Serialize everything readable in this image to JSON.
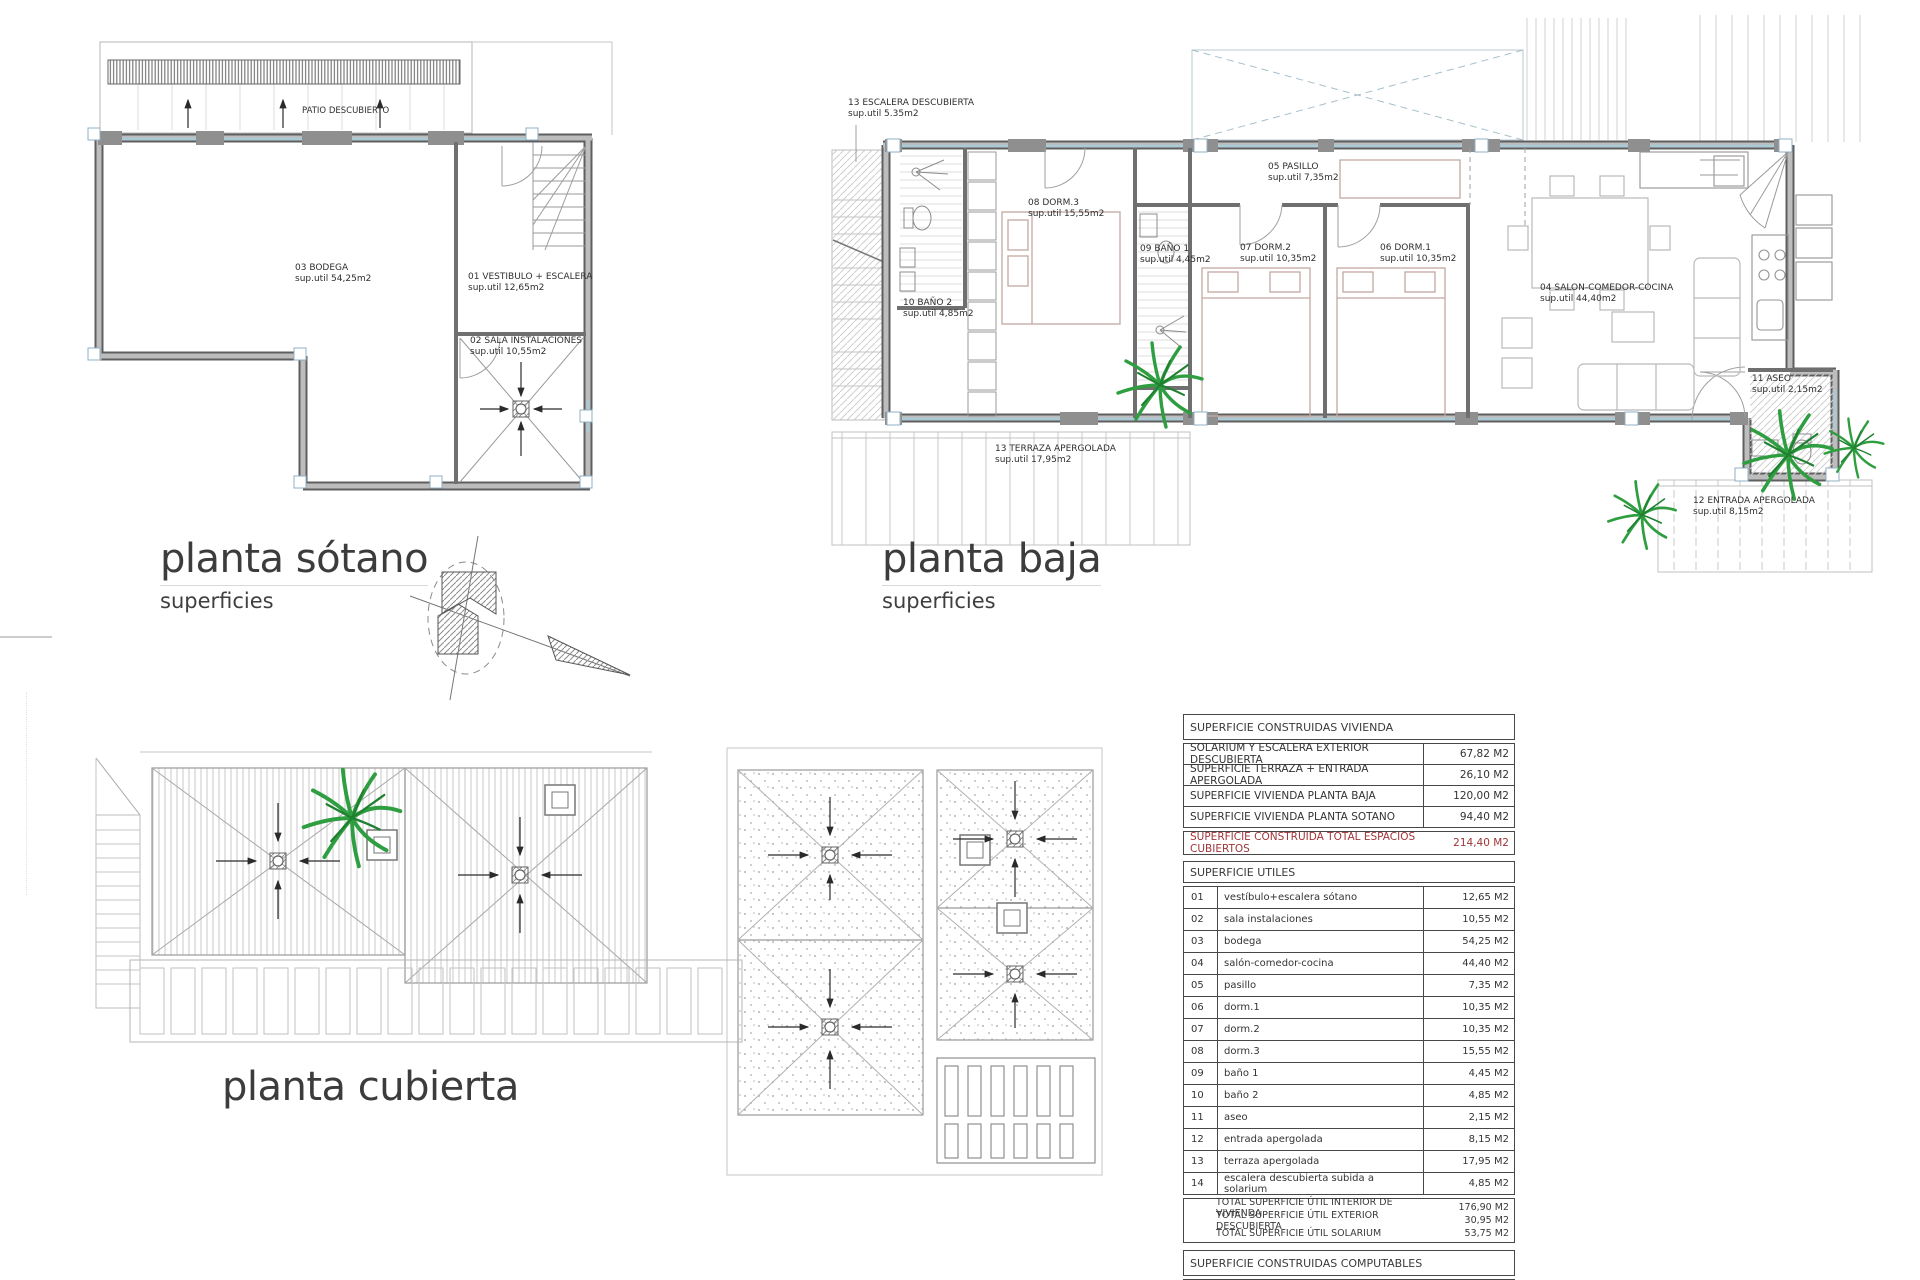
{
  "titles": {
    "sotano": {
      "title": "planta sótano",
      "subtitle": "superficies"
    },
    "baja": {
      "title": "planta baja",
      "subtitle": "superficies"
    },
    "cubierta": {
      "title": "planta cubierta"
    }
  },
  "plans": {
    "sotano": {
      "patio_label": "PATIO DESCUBIERTO",
      "rooms": [
        {
          "name": "03 BODEGA",
          "area": "sup.util 54,25m2"
        },
        {
          "name": "01 VESTIBULO + ESCALERA",
          "area": "sup.util 12,65m2"
        },
        {
          "name": "02 SALA INSTALACIONES",
          "area": "sup.util 10,55m2"
        }
      ]
    },
    "baja": {
      "rooms": [
        {
          "name": "13 ESCALERA DESCUBIERTA",
          "area": "sup.util 5.35m2"
        },
        {
          "name": "08 DORM.3",
          "area": "sup.util 15,55m2"
        },
        {
          "name": "09 BAÑO 1",
          "area": "sup.util 4,45m2"
        },
        {
          "name": "10 BAÑO 2",
          "area": "sup.util 4,85m2"
        },
        {
          "name": "05 PASILLO",
          "area": "sup.util 7,35m2"
        },
        {
          "name": "07 DORM.2",
          "area": "sup.util 10,35m2"
        },
        {
          "name": "06 DORM.1",
          "area": "sup.util 10,35m2"
        },
        {
          "name": "04 SALON-COMEDOR-COCINA",
          "area": "sup.util 44,40m2"
        },
        {
          "name": "13 TERRAZA APERGOLADA",
          "area": "sup.util 17,95m2"
        },
        {
          "name": "11 ASEO",
          "area": "sup.util 2,15m2"
        },
        {
          "name": "12 ENTRADA APERGOLADA",
          "area": "sup.util 8,15m2"
        }
      ]
    }
  },
  "tables": {
    "construidas": {
      "header": "SUPERFICIE CONSTRUIDAS VIVIENDA",
      "rows": [
        {
          "label": "SOLARIUM Y ESCALERA EXTERIOR DESCUBIERTA",
          "value": "67,82 M2"
        },
        {
          "label": "SUPERFICIE TERRAZA + ENTRADA APERGOLADA",
          "value": "26,10 M2"
        },
        {
          "label": "SUPERFICIE VIVIENDA PLANTA BAJA",
          "value": "120,00 M2"
        },
        {
          "label": "SUPERFICIE VIVIENDA PLANTA SOTANO",
          "value": "94,40 M2"
        }
      ],
      "total": {
        "label": "SUPERFICIE CONSTRUIDA TOTAL ESPACIOS CUBIERTOS",
        "value": "214,40 M2"
      }
    },
    "utiles": {
      "header": "SUPERFICIE UTILES",
      "rows": [
        {
          "num": "01",
          "label": "vestíbulo+escalera sótano",
          "value": "12,65 M2"
        },
        {
          "num": "02",
          "label": "sala instalaciones",
          "value": "10,55 M2"
        },
        {
          "num": "03",
          "label": "bodega",
          "value": "54,25 M2"
        },
        {
          "num": "04",
          "label": "salón-comedor-cocina",
          "value": "44,40 M2"
        },
        {
          "num": "05",
          "label": "pasillo",
          "value": "7,35 M2"
        },
        {
          "num": "06",
          "label": "dorm.1",
          "value": "10,35 M2"
        },
        {
          "num": "07",
          "label": "dorm.2",
          "value": "10,35 M2"
        },
        {
          "num": "08",
          "label": "dorm.3",
          "value": "15,55 M2"
        },
        {
          "num": "09",
          "label": "baño 1",
          "value": "4,45 M2"
        },
        {
          "num": "10",
          "label": "baño 2",
          "value": "4,85 M2"
        },
        {
          "num": "11",
          "label": "aseo",
          "value": "2,15 M2"
        },
        {
          "num": "12",
          "label": "entrada apergolada",
          "value": "8,15 M2"
        },
        {
          "num": "13",
          "label": "terraza apergolada",
          "value": "17,95 M2"
        },
        {
          "num": "14",
          "label": "escalera descubierta subida a solarium",
          "value": "4,85 M2"
        }
      ],
      "totals": [
        {
          "label": "TOTAL SUPERFICIE ÚTIL INTERIOR DE VIVIENDA",
          "value": "176,90 M2"
        },
        {
          "label": "TOTAL SUPERFICIE ÚTIL EXTERIOR DESCUBIERTA",
          "value": "30,95 M2"
        },
        {
          "label": "TOTAL SUPERFICIE ÚTIL SOLARIUM",
          "value": "53,75 M2"
        }
      ]
    },
    "computables": {
      "header": "SUPERFICIE CONSTRUIDAS COMPUTABLES",
      "rows": [
        {
          "label": "SUPERFICIE VIVIENDA",
          "value": "120,00 M2"
        }
      ]
    }
  },
  "margin_microtext": "··························································································",
  "colors": {
    "total_row_red": "#a03538",
    "plant_green": "#2f9e41",
    "window_blue": "#a9cbd8"
  }
}
